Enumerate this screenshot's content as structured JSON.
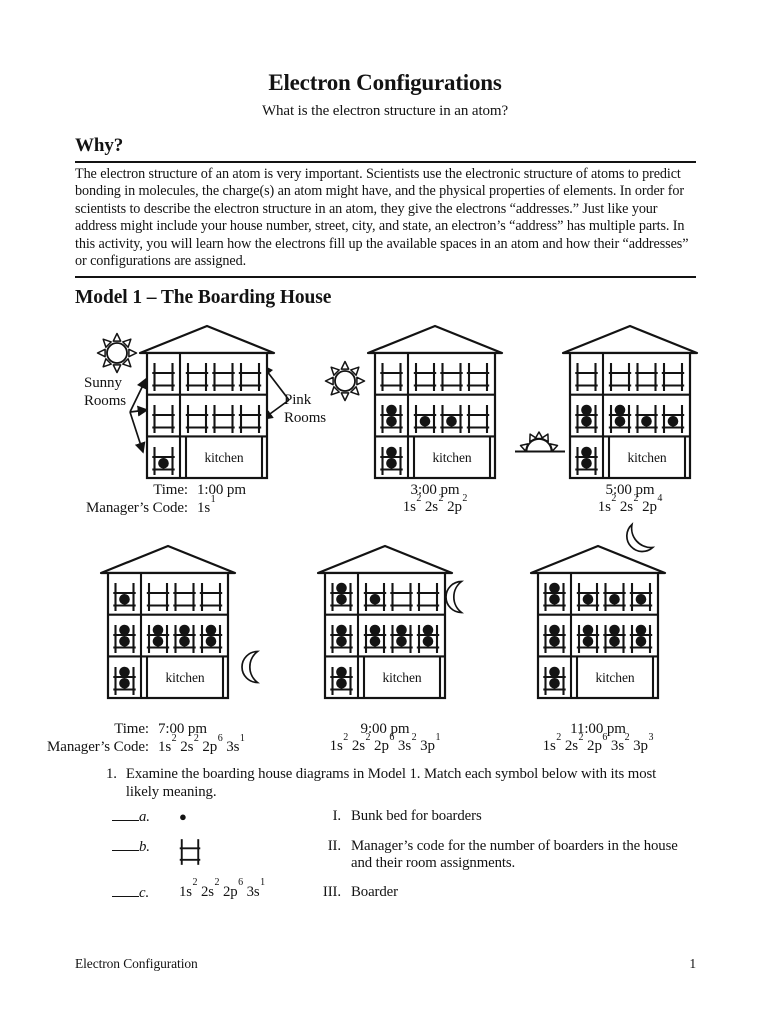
{
  "page": {
    "title": "Electron Configurations",
    "subtitle": "What is the electron structure in an atom?",
    "footer_left": "Electron Configuration",
    "footer_right": "1"
  },
  "why": {
    "heading": "Why?",
    "body": "The electron structure of an atom is very important. Scientists use the electronic structure of atoms to predict bonding in molecules, the charge(s) an atom might have, and the physical properties of elements. In order for scientists to describe the electron structure in an atom, they give the electrons “addresses.” Just like your address might include your house number, street, city, and state, an electron’s “address” has multiple parts. In this activity, you will learn how the electrons fill up the available spaces in an atom and how their “addresses” or configurations are assigned."
  },
  "model1": {
    "heading": "Model 1 – The Boarding House",
    "labels": {
      "sunny_rooms": "Sunny Rooms",
      "pink_rooms": "Pink Rooms",
      "kitchen": "kitchen",
      "time_prefix": "Time:",
      "code_prefix": "Manager’s Code:"
    },
    "houses": [
      {
        "time": "1:00 pm",
        "show_prefix": true,
        "celestial": "sun",
        "code": [
          [
            "1s",
            "1"
          ]
        ],
        "rooms": {
          "f3s": [
            0
          ],
          "f3p": [
            0,
            0,
            0
          ],
          "f2s": [
            0
          ],
          "f2p": [
            0,
            0,
            0
          ],
          "f1s": [
            1
          ]
        }
      },
      {
        "time": "3:00 pm",
        "show_prefix": false,
        "celestial": "sun",
        "code": [
          [
            "1s",
            "2"
          ],
          [
            "2s",
            "2"
          ],
          [
            "2p",
            "2"
          ]
        ],
        "rooms": {
          "f3s": [
            0
          ],
          "f3p": [
            0,
            0,
            0
          ],
          "f2s": [
            2
          ],
          "f2p": [
            1,
            1,
            0
          ],
          "f1s": [
            2
          ]
        }
      },
      {
        "time": "5:00 pm",
        "show_prefix": false,
        "celestial": "sunset",
        "code": [
          [
            "1s",
            "2"
          ],
          [
            "2s",
            "2"
          ],
          [
            "2p",
            "4"
          ]
        ],
        "rooms": {
          "f3s": [
            0
          ],
          "f3p": [
            0,
            0,
            0
          ],
          "f2s": [
            2
          ],
          "f2p": [
            2,
            1,
            1
          ],
          "f1s": [
            2
          ]
        }
      },
      {
        "time": "7:00 pm",
        "show_prefix": true,
        "celestial": "moon",
        "code": [
          [
            "1s",
            "2"
          ],
          [
            "2s",
            "2"
          ],
          [
            "2p",
            "6"
          ],
          [
            "3s",
            "1"
          ]
        ],
        "rooms": {
          "f3s": [
            1
          ],
          "f3p": [
            0,
            0,
            0
          ],
          "f2s": [
            2
          ],
          "f2p": [
            2,
            2,
            2
          ],
          "f1s": [
            2
          ]
        }
      },
      {
        "time": "9:00 pm",
        "show_prefix": false,
        "celestial": "moon",
        "code": [
          [
            "1s",
            "2"
          ],
          [
            "2s",
            "2"
          ],
          [
            "2p",
            "6"
          ],
          [
            "3s",
            "2"
          ],
          [
            "3p",
            "1"
          ]
        ],
        "rooms": {
          "f3s": [
            2
          ],
          "f3p": [
            1,
            0,
            0
          ],
          "f2s": [
            2
          ],
          "f2p": [
            2,
            2,
            2
          ],
          "f1s": [
            2
          ]
        }
      },
      {
        "time": "11:00 pm",
        "show_prefix": false,
        "celestial": "moon",
        "code": [
          [
            "1s",
            "2"
          ],
          [
            "2s",
            "2"
          ],
          [
            "2p",
            "6"
          ],
          [
            "3s",
            "2"
          ],
          [
            "3p",
            "3"
          ]
        ],
        "rooms": {
          "f3s": [
            2
          ],
          "f3p": [
            1,
            1,
            1
          ],
          "f2s": [
            2
          ],
          "f2p": [
            2,
            2,
            2
          ],
          "f1s": [
            2
          ]
        }
      }
    ]
  },
  "question": {
    "number": "1.",
    "text": "Examine the boarding house diagrams in Model 1. Match each symbol below with its most likely meaning.",
    "symbols": {
      "boarder_glyph": "●",
      "code_c": [
        [
          "1s",
          "2"
        ],
        [
          "2s",
          "2"
        ],
        [
          "2p",
          "6"
        ],
        [
          "3s",
          "1"
        ]
      ]
    },
    "rows": [
      {
        "letter": "a.",
        "roman": "I.",
        "meaning": "Bunk bed for boarders"
      },
      {
        "letter": "b.",
        "roman": "II.",
        "meaning": "Manager’s code for the number of boarders in the house and their room assignments."
      },
      {
        "letter": "c.",
        "roman": "III.",
        "meaning": "Boarder"
      }
    ]
  }
}
